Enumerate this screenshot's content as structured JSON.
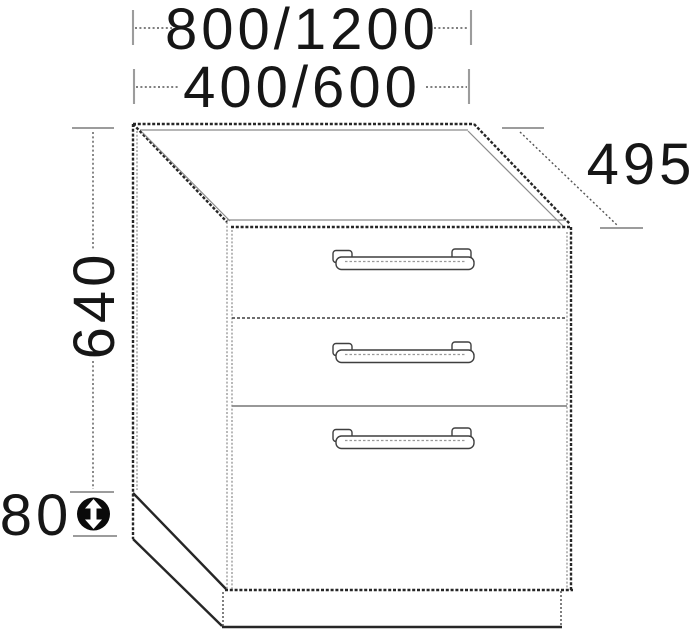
{
  "diagram": {
    "name": "three-drawer-base-cabinet-dimension-drawing",
    "background": "#ffffff",
    "colors": {
      "outline": "#262626",
      "secondary_line": "#8a8a8a",
      "dimension_line": "#555555",
      "tick": "#9c9c9c",
      "text": "#161616",
      "icon_fill": "#0a0a0a",
      "icon_arrow": "#ffffff"
    },
    "dimensions": {
      "width_primary": "800/1200",
      "width_secondary": "400/600",
      "depth": "495",
      "height": "640",
      "plinth_height": "80"
    },
    "cabinet": {
      "drawer_count": 3,
      "handles_per_drawer": 1
    },
    "icon": {
      "name": "height-adjustable-icon",
      "meaning": "double-headed vertical arrow in filled circle (adjustable plinth height)"
    }
  }
}
